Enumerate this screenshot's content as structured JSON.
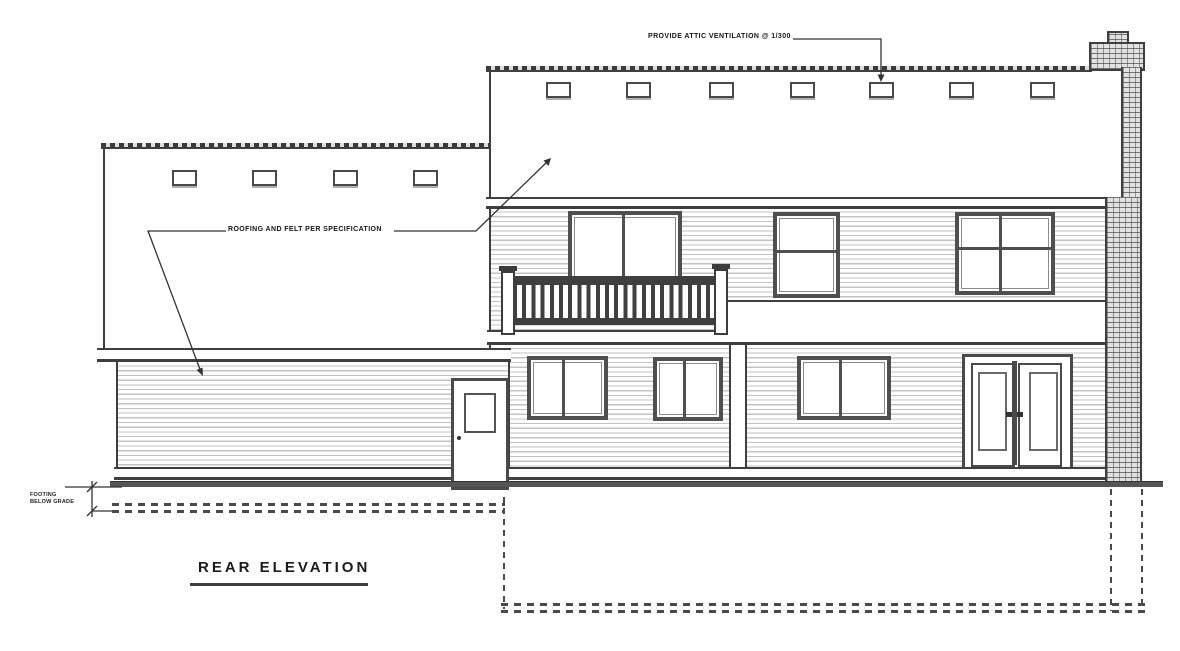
{
  "drawing": {
    "title": "REAR ELEVATION",
    "notes": {
      "attic": "PROVIDE ATTIC VENTILATION @ 1/300",
      "roofing": "ROOFING AND FELT PER SPECIFICATION",
      "grade_line1": "FOOTING",
      "grade_line2": "BELOW GRADE"
    },
    "colors": {
      "ink": "#3f3f3f",
      "paper": "#ffffff",
      "siding_line": "#c3c3c3"
    }
  }
}
